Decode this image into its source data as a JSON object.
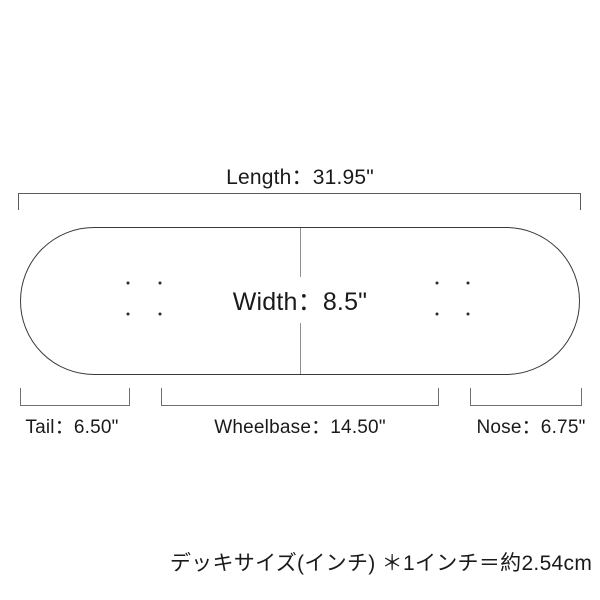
{
  "diagram": {
    "title": "skateboard-deck-size-diagram",
    "length_label": "Length：31.95\"",
    "width_label": "Width：8.5\"",
    "tail_label": "Tail：6.50\"",
    "wheelbase_label": "Wheelbase：14.50\"",
    "nose_label": "Nose：6.75\"",
    "note": "デッキサイズ(インチ) ＊1インチ＝約2.54cm",
    "measurements": {
      "length_in": 31.95,
      "width_in": 8.5,
      "tail_in": 6.5,
      "wheelbase_in": 14.5,
      "nose_in": 6.75
    }
  },
  "colors": {
    "background": "#ffffff",
    "text": "#1a1a1a",
    "deck_outline": "#3a3a3a",
    "dimension_line": "#5a5a5a",
    "bracket_line": "#6f6f6f",
    "width_line": "#8f8f8f",
    "mounting_hole": "#2a2a2a"
  }
}
